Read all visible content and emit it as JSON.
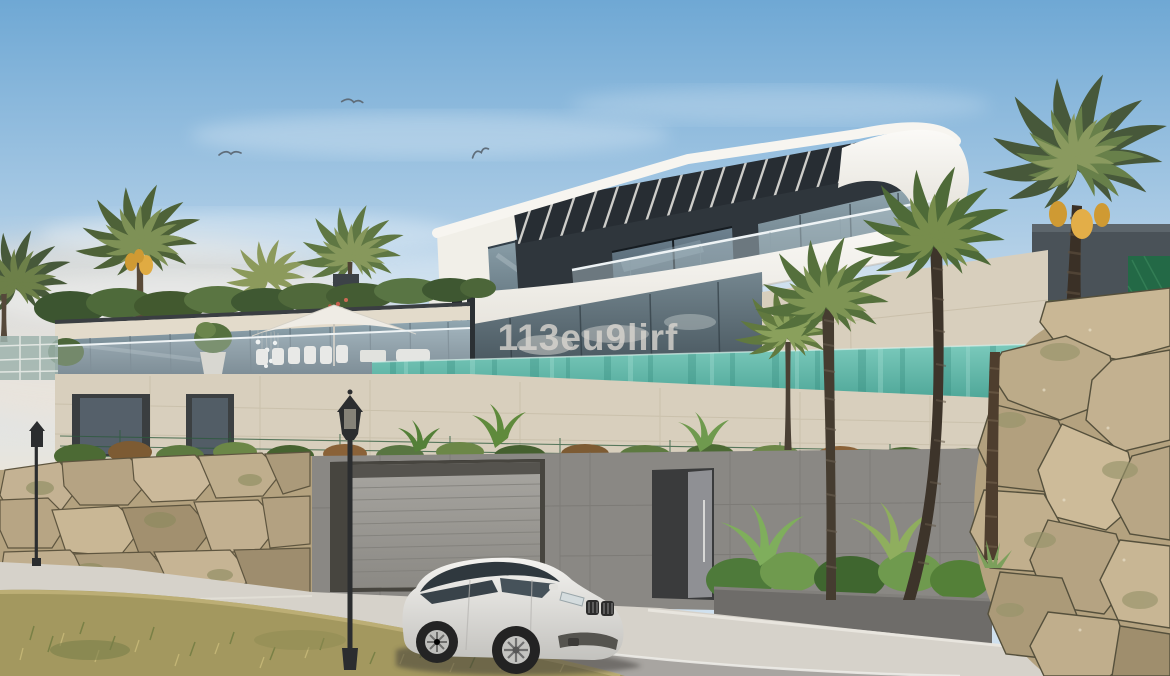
{
  "scene": {
    "type": "architectural exterior render",
    "subject": "modern hillside villa with infinity pool, palm trees, stone walls and a white SUV on the street",
    "bird_count": "3"
  },
  "watermark": {
    "text": "113eu9lirf"
  },
  "palette": {
    "sky_top": "#6fa8d4",
    "sky_mid": "#aecde6",
    "sky_horizon": "#e9e5dc",
    "horizon_glow": "#f4e3d0",
    "roof_white": "#f7f5f0",
    "louver_dark": "#272d33",
    "glass_blue": "#7e929e",
    "pool_top": "#7bcabc",
    "pool_bottom": "#3f9a8b",
    "stone_beige": "#d8cfbd",
    "concrete_gray": "#8a8884",
    "asphalt_gray": "#a8a5a1",
    "sidewalk_light": "#d6d2ca",
    "rock_tan": "#b4a27f",
    "grass_dry": "#a3985f",
    "palm_green": "#556d3a",
    "dates_orange": "#cf9a33",
    "car_white": "#eceae6",
    "lamp_black": "#2b2d2f"
  }
}
